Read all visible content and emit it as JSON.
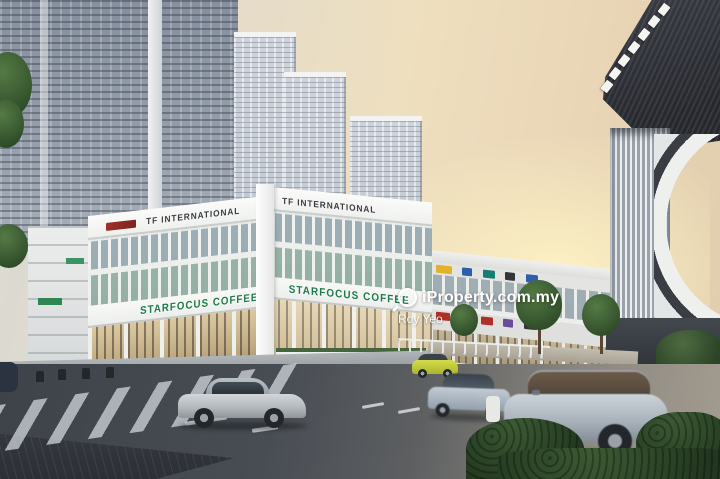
{
  "watermark": {
    "brand": "iProperty.com.my",
    "agent": "Roy Yeo"
  },
  "signs": {
    "rooftop_left": "TF INTERNATIONAL",
    "rooftop_right": "TF INTERNATIONAL",
    "fascia_left": "STARFOCUS COFFEE",
    "fascia_right": "STARFOCUS COFFEE"
  },
  "colors": {
    "sign_green": "#1e7a4a",
    "rooftop_sign_dark": "#2a2d31",
    "parapet_red_sign": "#9c2f24",
    "sky_warm": "#eedfbf",
    "hedge_green": "#2c432a",
    "watermark_white": "#ffffff"
  }
}
